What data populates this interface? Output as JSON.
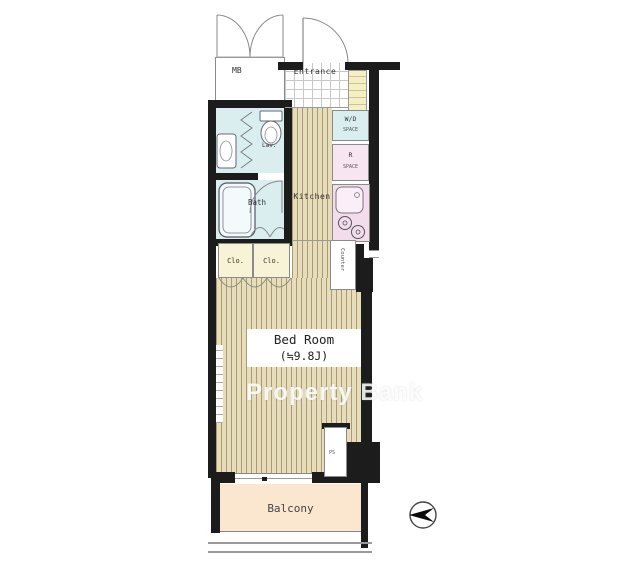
{
  "plan": {
    "mb_label": "MB",
    "entrance_label": "Entrance",
    "wd_label": "W/D",
    "wd_sub": "SPACE",
    "r_label": "R",
    "r_sub": "SPACE",
    "kitchen_label": "Kitchen",
    "lav_label": "Lav.",
    "bath_label": "Bath",
    "closet1_label": "Clo.",
    "closet2_label": "Clo.",
    "counter_label": "Counter",
    "bedroom_label": "Bed Room",
    "bedroom_size": "(≒9.8J)",
    "ps_label": "PS",
    "balcony_label": "Balcony"
  },
  "watermark": {
    "text": "Property Bank"
  },
  "colors": {
    "wall": "#1c1c1c",
    "flooring_light": "#e7ddbb",
    "flooring_stripe": "#a99c74",
    "wet_area": "#daeef0",
    "kitchen_fixture": "#f3dcee",
    "closet": "#f8f3d6",
    "shoe_cabinet": "#f4f0c4",
    "balcony": "#fbe7d0",
    "watermark_text": "#ffffff"
  }
}
